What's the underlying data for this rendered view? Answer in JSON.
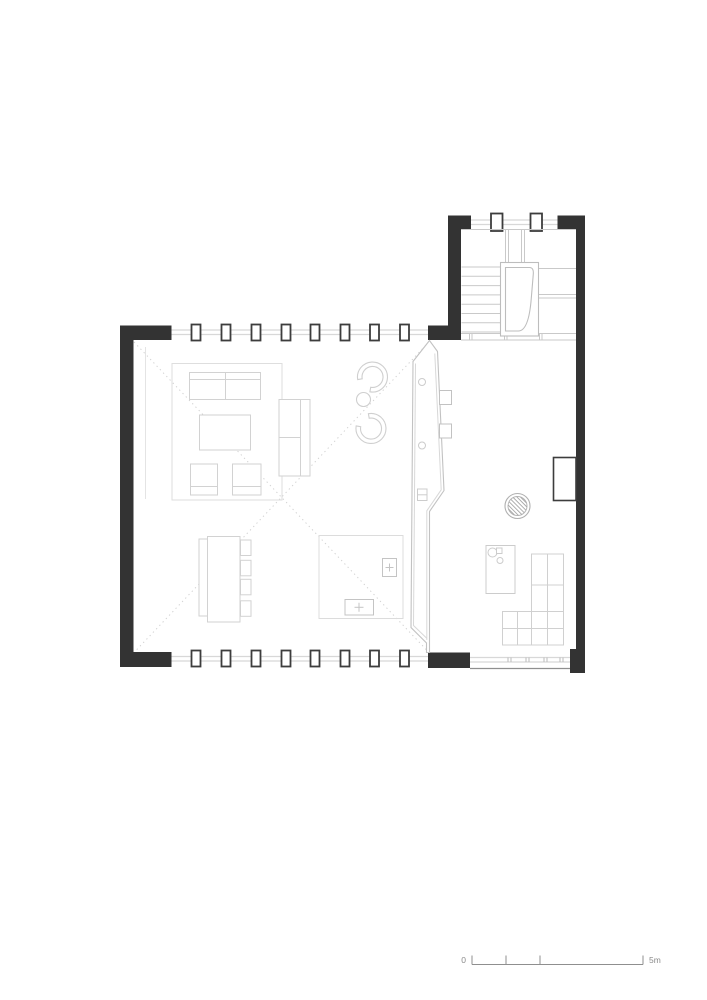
{
  "scale_bar": {
    "start_label": "0",
    "end_label": "5m",
    "tick_positions_m": [
      0,
      1,
      2,
      5
    ]
  },
  "colors": {
    "background": "#ffffff",
    "wall_black": "#333333",
    "mullion_stroke": "#3d3d3d",
    "glazing": "#d8d8d8",
    "stair_lines": "#c9c9c9",
    "furniture": "#d2d2d2",
    "partition": "#c2c2c2",
    "dotted_ceiling_line": "#d2d2d2",
    "scale_bar": "#8f8f8f",
    "scale_text": "#8a8a8a"
  }
}
